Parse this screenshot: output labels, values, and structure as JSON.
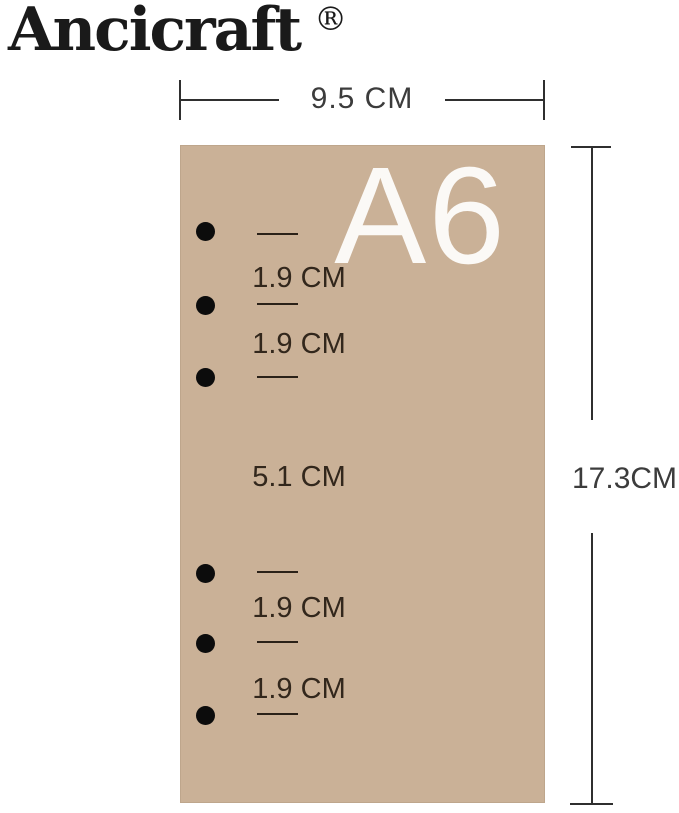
{
  "brand": {
    "name": "Ancicraft",
    "registered_mark": "®"
  },
  "product": {
    "size_label": "A6",
    "hole_count": 6
  },
  "measurements": {
    "width": "9.5 CM",
    "height": "17.3CM",
    "top_hole_gaps": [
      "1.9 CM",
      "1.9 CM"
    ],
    "middle_gap": "5.1 CM",
    "bottom_hole_gaps": [
      "1.9 CM",
      "1.9 CM"
    ]
  },
  "colors": {
    "paper": "#cab197",
    "hole": "#0c0c0c",
    "dimension_line": "#2f2f2f",
    "dimension_text": "#3c3c3c",
    "paper_annotation_text": "#32271c",
    "size_label_text": "#fbf9f6",
    "background": "#ffffff"
  }
}
